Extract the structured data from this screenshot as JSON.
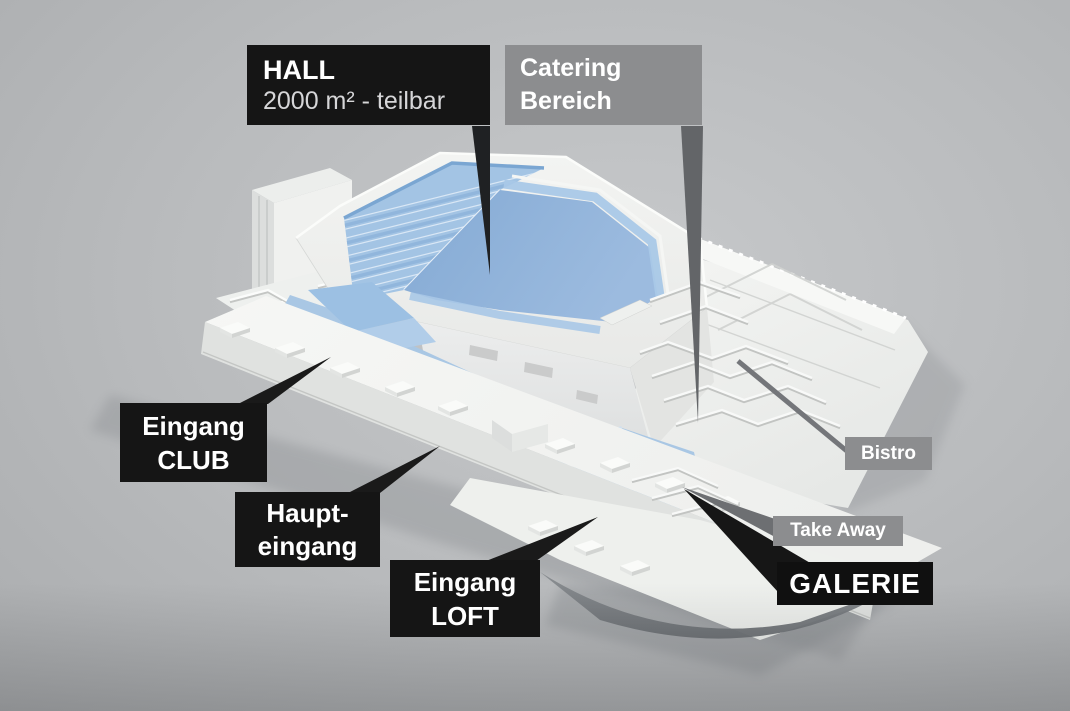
{
  "labels": {
    "hall": {
      "title": "HALL",
      "subtitle": "2000 m² - teilbar"
    },
    "catering": {
      "line1": "Catering",
      "line2": "Bereich"
    },
    "eingang_club": {
      "line1": "Eingang",
      "line2": "CLUB"
    },
    "haupteingang": {
      "line1": "Haupt-",
      "line2": "eingang"
    },
    "eingang_loft": {
      "line1": "Eingang",
      "line2": "LOFT"
    },
    "bistro": {
      "text": "Bistro"
    },
    "take_away": {
      "text": "Take Away"
    },
    "galerie": {
      "text": "GALERIE"
    }
  },
  "colors": {
    "background": "#b8babc",
    "label_black_bg": "#151515",
    "label_gray_bg": "#8c8d8f",
    "label_text": "#ffffff",
    "hall_subtitle_text": "#d6d6d8",
    "hall_floor_blue": "#8db1d8",
    "seating_blue": "#a3c4e4",
    "walkway_blue": "#a9c7e4",
    "building_white": "#f2f3f1",
    "pointer_black": "#1a1a1a",
    "pointer_gray": "#6d6f72"
  }
}
